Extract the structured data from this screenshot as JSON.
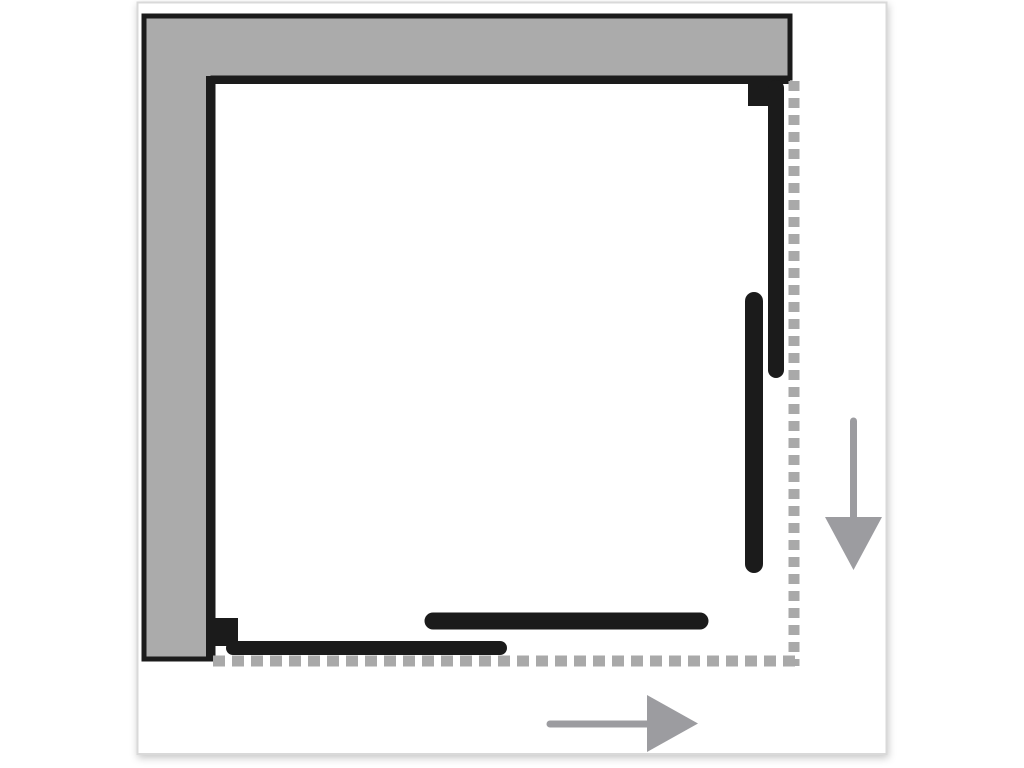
{
  "page": {
    "background_color": "#ffffff"
  },
  "frame": {
    "fill_color": "#ffffff",
    "border_color": "#d9d9d9"
  },
  "diagram": {
    "wall_fill_color": "#ababab",
    "outline_color": "#1b1b1b",
    "panel_color": "#1b1b1b",
    "dashed_line_color": "#a9a9a9",
    "arrow_color": "#9c9ca0"
  },
  "icons": {
    "right_side_arrow": "arrow-down",
    "bottom_arrow": "arrow-right"
  }
}
